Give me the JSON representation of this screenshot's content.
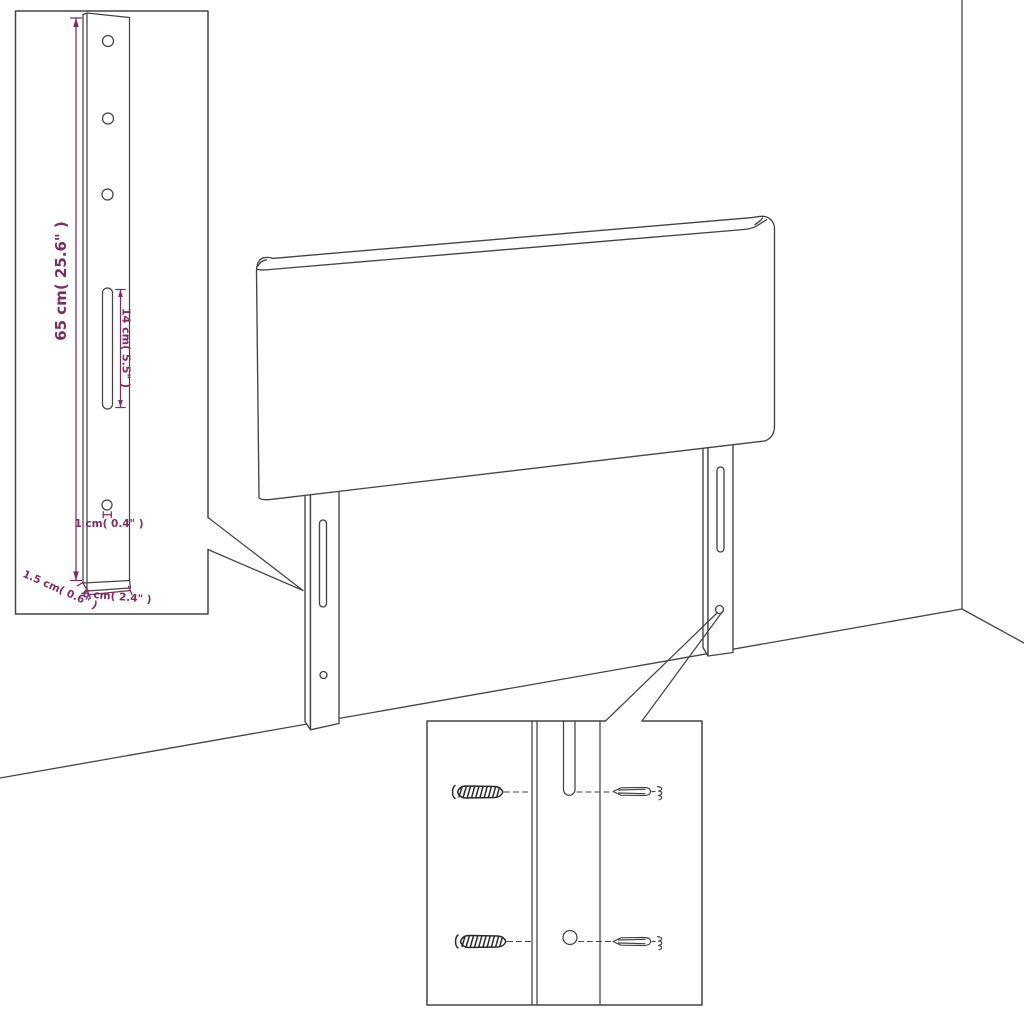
{
  "diagram": {
    "kind": "furniture-dimension-diagram",
    "subject": "upholstered headboard with two mounting legs, wall corner background, two detail insets"
  },
  "colors": {
    "background": "#ffffff",
    "ink": "#444444",
    "screw_ink": "#2b2b2b",
    "dimension": "#7d2d5f"
  },
  "labels": {
    "leg_height": "65 cm( 25.6\" )",
    "slot_length": "14 cm( 5.5\" )",
    "hole_size": "1 cm( 0.4\" )",
    "leg_depth": "1.5 cm( 0.6\" )",
    "leg_width": "6 cm( 2.4\" )"
  }
}
